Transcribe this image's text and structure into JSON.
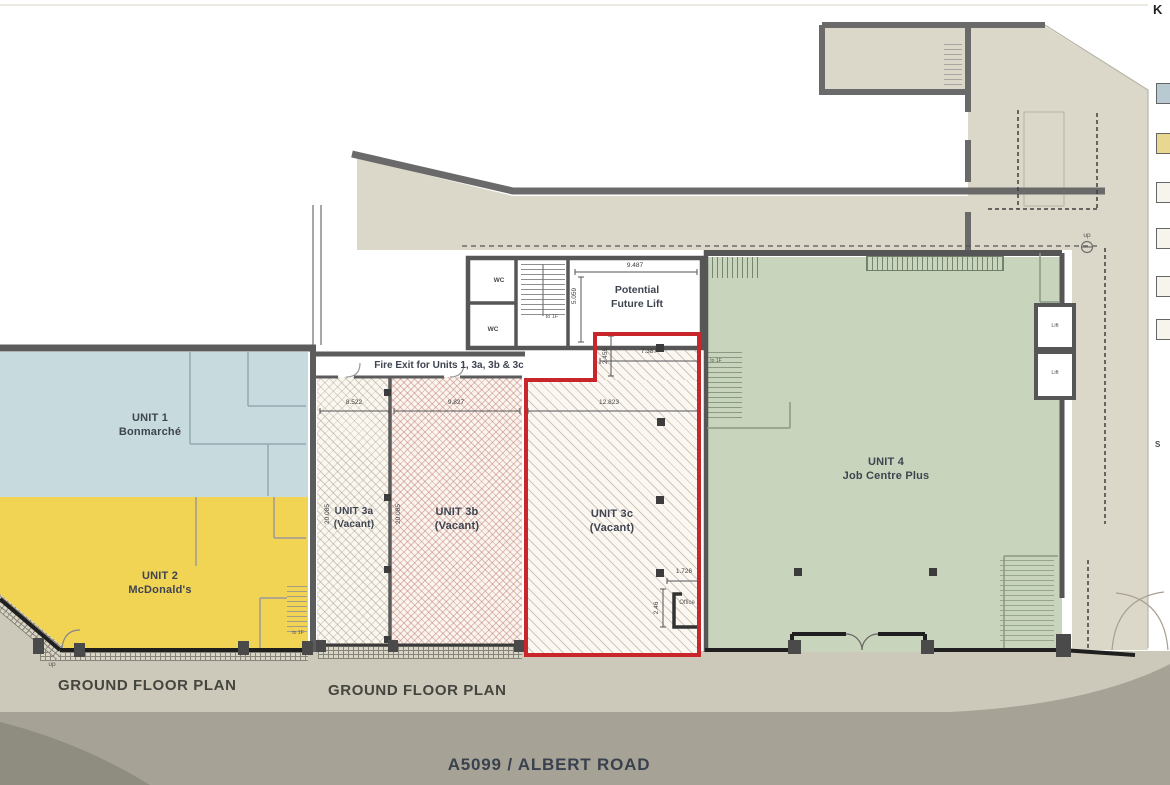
{
  "legend": {
    "key_label": "K",
    "swatches": [
      {
        "name": "unit-1",
        "color": "#b9c9d1"
      },
      {
        "name": "unit-2",
        "color": "#e8d88f"
      },
      {
        "name": "unit-3a",
        "color": "#f7f4ed"
      },
      {
        "name": "unit-3b",
        "color": "#f7f4ed"
      },
      {
        "name": "unit-3c",
        "color": "#f7f4ed"
      },
      {
        "name": "unit-4",
        "color": "#f7f4ed"
      }
    ]
  },
  "units": {
    "unit1": {
      "name": "UNIT 1",
      "tenant": "Bonmarché"
    },
    "unit2": {
      "name": "UNIT 2",
      "tenant": "McDonald's"
    },
    "unit3a": {
      "name": "UNIT 3a",
      "tenant": "(Vacant)"
    },
    "unit3b": {
      "name": "UNIT 3b",
      "tenant": "(Vacant)"
    },
    "unit3c": {
      "name": "UNIT 3c",
      "tenant": "(Vacant)"
    },
    "unit4": {
      "name": "UNIT 4",
      "tenant": "Job Centre Plus"
    }
  },
  "rooms": {
    "wc_upper": "WC",
    "wc_lower": "WC",
    "future_lift_line1": "Potential",
    "future_lift_line2": "Future Lift",
    "lift_upper": "Lift",
    "lift_lower": "Lift",
    "office": "Office"
  },
  "annotations": {
    "fire_exit": "Fire Exit for Units 1, 3a, 3b & 3c",
    "to_1f_stair": "to 1F",
    "to_1f_unit2": "to 1F",
    "to_1f_unit4": "to 1F",
    "up_right": "up",
    "up_left": "up",
    "side_fragment": "S"
  },
  "dimensions": {
    "lift_width": "9.487",
    "lift_depth": "5.059",
    "unit3c_upper_width": "7.387",
    "unit3c_upper_depth": "2.455",
    "unit3c_width": "12.823",
    "unit3a_width": "8.522",
    "unit3b_width": "9.827",
    "unit3a_depth": "20.085",
    "unit3b_depth": "20.085",
    "office_width": "1.726",
    "office_depth": "2.46"
  },
  "titles": {
    "plan_left": "GROUND FLOOR PLAN",
    "plan_right": "GROUND FLOOR PLAN",
    "road": "A5099 / ALBERT ROAD"
  },
  "colors": {
    "unit1_fill": "#c7dade",
    "unit2_fill": "#f2d455",
    "unit4_fill": "#c9d4bc",
    "unit3c_outline": "#c9262c",
    "wall": "#5c5c5c",
    "surround": "#dcd8c9",
    "sidewalk": "#cdc9ba",
    "road": "#a6a396"
  }
}
